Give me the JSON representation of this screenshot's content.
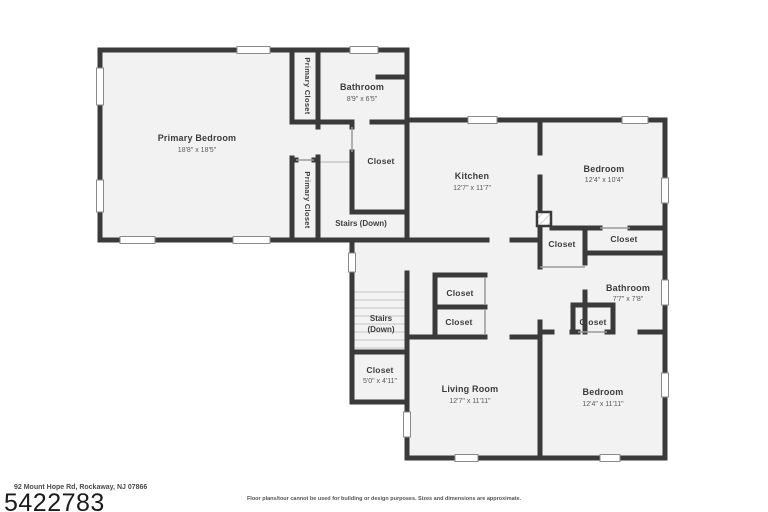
{
  "colors": {
    "wall": "#3a3a3a",
    "floor": "#f2f2f2",
    "bg": "#ffffff"
  },
  "floor_plan": {
    "rooms": {
      "primary_bedroom": {
        "name": "Primary Bedroom",
        "dims": "18'8\" x 18'5\""
      },
      "primary_closet_top": {
        "name": "Primary Closet"
      },
      "primary_closet_bottom": {
        "name": "Primary Closet"
      },
      "bathroom_upper": {
        "name": "Bathroom",
        "dims": "8'9\" x 6'5\""
      },
      "closet_upper": {
        "name": "Closet"
      },
      "stairs_upper": {
        "name": "Stairs (Down)"
      },
      "kitchen": {
        "name": "Kitchen",
        "dims": "12'7\" x 11'7\""
      },
      "bedroom_upper_right": {
        "name": "Bedroom",
        "dims": "12'4\" x 10'4\""
      },
      "closet_hall_left": {
        "name": "Closet"
      },
      "closet_hall_right": {
        "name": "Closet"
      },
      "bathroom_right": {
        "name": "Bathroom",
        "dims": "7'7\" x 7'8\""
      },
      "closet_bath": {
        "name": "Closet"
      },
      "closet_mid_top": {
        "name": "Closet"
      },
      "closet_mid_bottom": {
        "name": "Closet"
      },
      "stairs_lower": {
        "line1": "Stairs",
        "line2": "(Down)"
      },
      "closet_under_stairs": {
        "name": "Closet",
        "dims": "5'0\" x 4'11\""
      },
      "living_room": {
        "name": "Living Room",
        "dims": "12'7\" x 11'11\""
      },
      "bedroom_lower_right": {
        "name": "Bedroom",
        "dims": "12'4\" x 11'11\""
      }
    },
    "footer": {
      "address": "92 Mount Hope Rd, Rockaway, NJ 07866",
      "listing_number": "5422783",
      "disclaimer": "Floor plans/tour cannot be used for building or design purposes. Sizes and dimensions are approximate."
    }
  }
}
